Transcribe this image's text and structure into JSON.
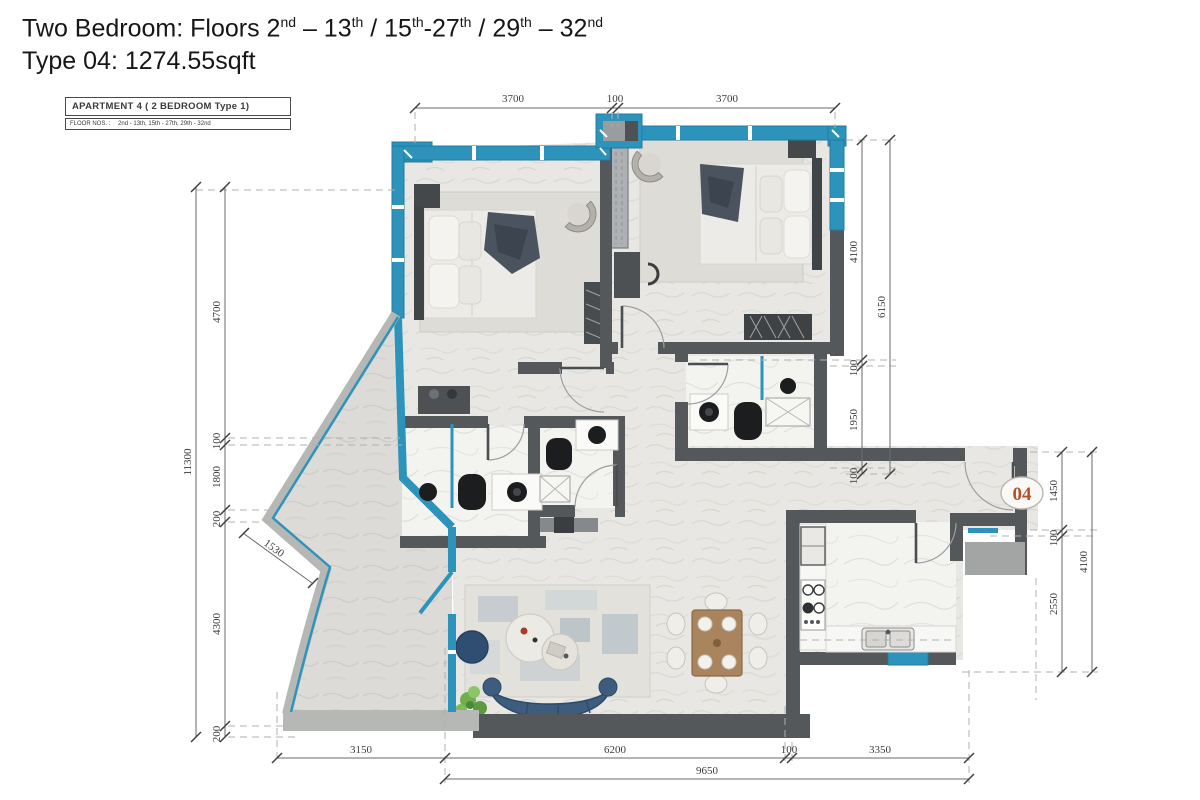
{
  "header": {
    "title_line1_segments": [
      {
        "text": "Two Bedroom: Floors 2",
        "sup": "nd"
      },
      {
        "text": " – 13",
        "sup": "th"
      },
      {
        "text": " / 15",
        "sup": "th"
      },
      {
        "text": "-27",
        "sup": "th"
      },
      {
        "text": " / 29",
        "sup": "th"
      },
      {
        "text": " – 32",
        "sup": "nd"
      }
    ],
    "title_line2": "Type 04: 1274.55sqft"
  },
  "title_block": {
    "line1": "APARTMENT  4  ( 2 BEDROOM Type 1)",
    "line2_label": "FLOOR NOS. :",
    "line2_value": "2nd - 13th, 15th - 27th, 29th - 32nd"
  },
  "unit_badge": "04",
  "dimensions": {
    "top": [
      "3700",
      "100",
      "3700"
    ],
    "left_inner": [
      "4700",
      "100",
      "1800",
      "200",
      "4300",
      "200"
    ],
    "left_outer": "11300",
    "right_upper_inner": [
      "4100",
      "100",
      "1950",
      "100"
    ],
    "right_upper_outer": "6150",
    "right_lower_inner": [
      "1450",
      "100",
      "2550"
    ],
    "right_lower_outer": "4100",
    "bottom_inner": [
      "3150",
      "6200",
      "100",
      "3350"
    ],
    "bottom_outer": "9650",
    "balcony_edge": "1530"
  },
  "colors": {
    "glazing": "#2e93ba",
    "wall_dark": "#54585b",
    "wall_light": "#b6b8b5",
    "floor": "#e8e7e3",
    "unit_number": "#b5502c"
  }
}
